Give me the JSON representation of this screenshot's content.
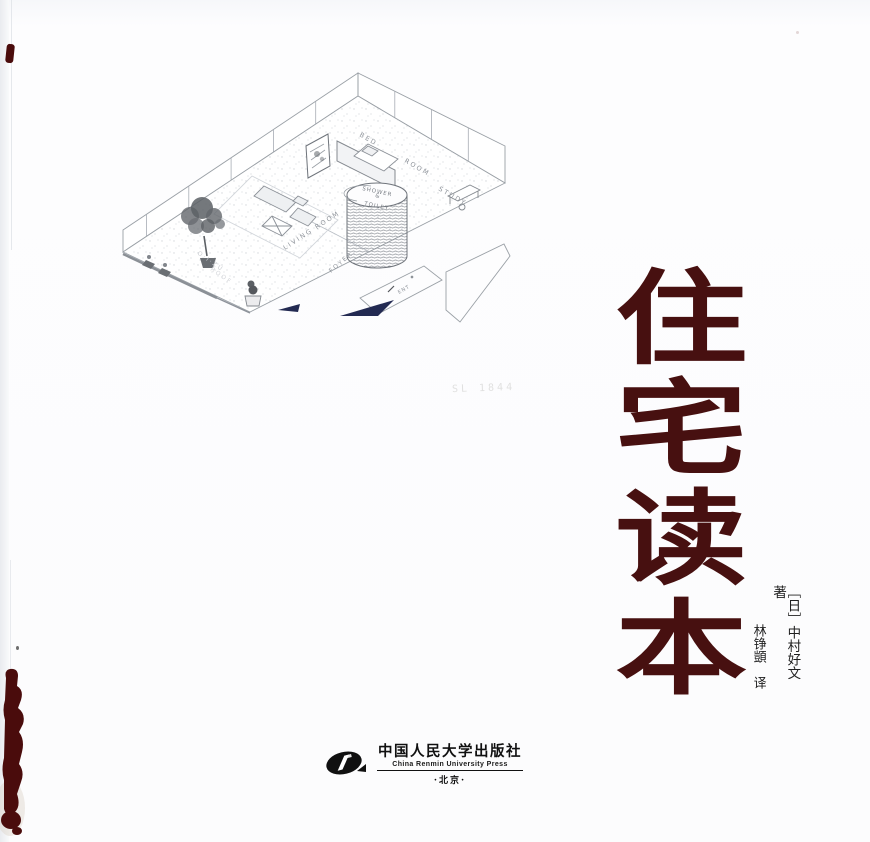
{
  "cover": {
    "title": {
      "text": "住宅读本",
      "color": "#471010"
    },
    "authors": {
      "original": "［日］中村好文　著",
      "translator": "林铮顗　译"
    },
    "publisher": {
      "logo": "china-renmin-university-press-logo",
      "name_cn": "中国人民大学出版社",
      "name_en": "China Renmin University Press",
      "city": "·北京·"
    },
    "sketch": {
      "description": "hand-drawn isometric cutaway of a one-room house",
      "labels": {
        "bed": "BED",
        "room": "ROOM",
        "study": "STUDY",
        "shower": "SHOWER",
        "and": "&",
        "toilet": "TOILET",
        "living_room": "LIVING ROOM",
        "foyer": "FOYER",
        "entrance": "ENT",
        "faint_note_1": "O·I·ZU",
        "faint_note_2": "ROOF"
      },
      "pencil_note": "SL 1844"
    },
    "colors": {
      "title_maroon": "#471010",
      "ink_stain": "#4a0c0c",
      "sketch_line": "#9aa0a6",
      "shadow_navy": "#232a52"
    }
  }
}
